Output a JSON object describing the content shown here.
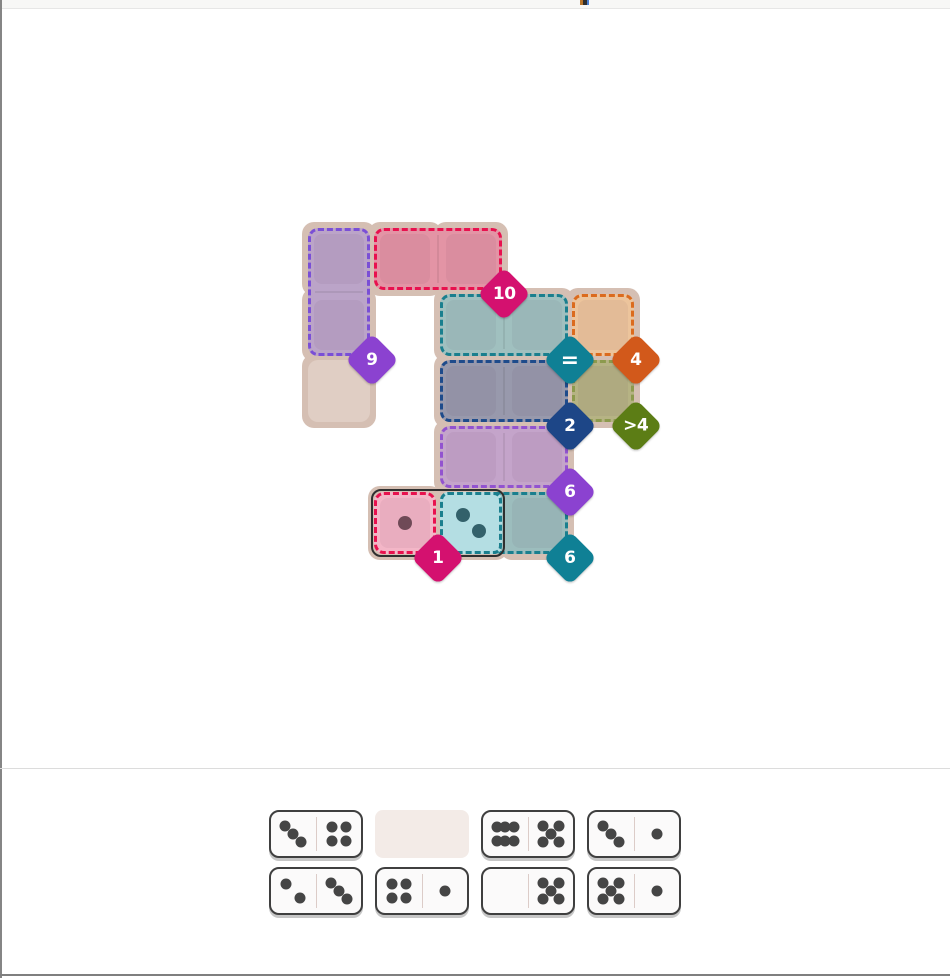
{
  "page": {
    "width": 950,
    "height": 978,
    "chrome": {
      "left_border_color": "#858585",
      "bottom_border_color": "#7f7f7f",
      "top_strip_color": "#f7f7f6",
      "divider_color": "#dcdcdc",
      "background": "#ffffff"
    }
  },
  "board": {
    "grid": {
      "origin_x": 308,
      "origin_y": 228,
      "cell": 62,
      "pitch": 66,
      "pad": 6
    },
    "panel_color": "#d5bfb3",
    "empty_cell_color": "#e0cec4",
    "base_cells": [
      [
        0,
        0
      ],
      [
        0,
        1
      ],
      [
        0,
        2
      ],
      [
        1,
        0
      ],
      [
        2,
        0
      ],
      [
        2,
        1
      ],
      [
        3,
        1
      ],
      [
        4,
        1
      ],
      [
        2,
        2
      ],
      [
        3,
        2
      ],
      [
        4,
        2
      ],
      [
        2,
        3
      ],
      [
        3,
        3
      ],
      [
        1,
        4
      ],
      [
        2,
        4
      ],
      [
        3,
        4
      ]
    ],
    "free_cells": [
      [
        0,
        2
      ]
    ],
    "regions": [
      {
        "id": "nine",
        "badge_label": "9",
        "col": 0,
        "row": 0,
        "cols": 1,
        "rows": 2,
        "fill": "#bba4c8",
        "border": "#7a4fd6",
        "badge_color": "#8b42d0"
      },
      {
        "id": "ten",
        "badge_label": "10",
        "col": 1,
        "row": 0,
        "cols": 2,
        "rows": 1,
        "fill": "#e394a5",
        "border": "#e8114e",
        "badge_color": "#d4116f"
      },
      {
        "id": "equals",
        "badge_label": "=",
        "col": 2,
        "row": 1,
        "cols": 2,
        "rows": 1,
        "fill": "#a0c0bf",
        "border": "#1a7f8e",
        "badge_color": "#0f8095"
      },
      {
        "id": "four",
        "badge_label": "4",
        "col": 4,
        "row": 1,
        "cols": 1,
        "rows": 1,
        "fill": "#ecc49c",
        "border": "#db6b1e",
        "badge_color": "#d2591b"
      },
      {
        "id": "two",
        "badge_label": "2",
        "col": 2,
        "row": 2,
        "cols": 2,
        "rows": 1,
        "fill": "#9899ac",
        "border": "#1e4b8b",
        "badge_color": "#1d4687"
      },
      {
        "id": "greater-than-4",
        "badge_label": ">4",
        "col": 4,
        "row": 2,
        "cols": 1,
        "rows": 1,
        "fill": "#b6b384",
        "border": "#8c9a4d",
        "badge_color": "#5c7d15"
      },
      {
        "id": "six-purple",
        "badge_label": "6",
        "col": 2,
        "row": 3,
        "cols": 2,
        "rows": 1,
        "fill": "#c4a4ca",
        "border": "#9253cf",
        "badge_color": "#8b42d0"
      },
      {
        "id": "one",
        "badge_label": "1",
        "col": 1,
        "row": 4,
        "cols": 1,
        "rows": 1,
        "fill": "#f3b6c7",
        "border": "#e8114e",
        "badge_color": "#d4116f"
      },
      {
        "id": "six-teal",
        "badge_label": "6",
        "col": 2,
        "row": 4,
        "cols": 2,
        "rows": 1,
        "fill": "#9cbdbd",
        "border": "#1a7f8e",
        "badge_color": "#0f8095"
      }
    ],
    "placed_domino": {
      "name": "1-2",
      "outline_color": "#2f2f2f",
      "halves": [
        {
          "col": 1,
          "row": 4,
          "pips": 1,
          "fill": "",
          "border": "",
          "pip_color": "#6f4a57"
        },
        {
          "col": 2,
          "row": 4,
          "pips": 2,
          "fill": "#b4dee3",
          "border": "#1a7f8e",
          "pip_color": "#33616b"
        }
      ]
    }
  },
  "tray": {
    "tile": {
      "bg": "#fbfafa",
      "border_color": "#3f3f3f",
      "divider_color": "#dcccc8",
      "pip_color": "#454545",
      "shadow_color": "#c6c6c6",
      "empty_slot_color": "#f3ebe7"
    },
    "rows": [
      [
        {
          "left": 3,
          "right": 4
        },
        {
          "empty": true
        },
        {
          "left": 6,
          "right": 5
        },
        {
          "left": 3,
          "right": 1
        }
      ],
      [
        {
          "left": 2,
          "right": 3
        },
        {
          "left": 4,
          "right": 1
        },
        {
          "left": 0,
          "right": 5
        },
        {
          "left": 5,
          "right": 1
        }
      ]
    ]
  }
}
